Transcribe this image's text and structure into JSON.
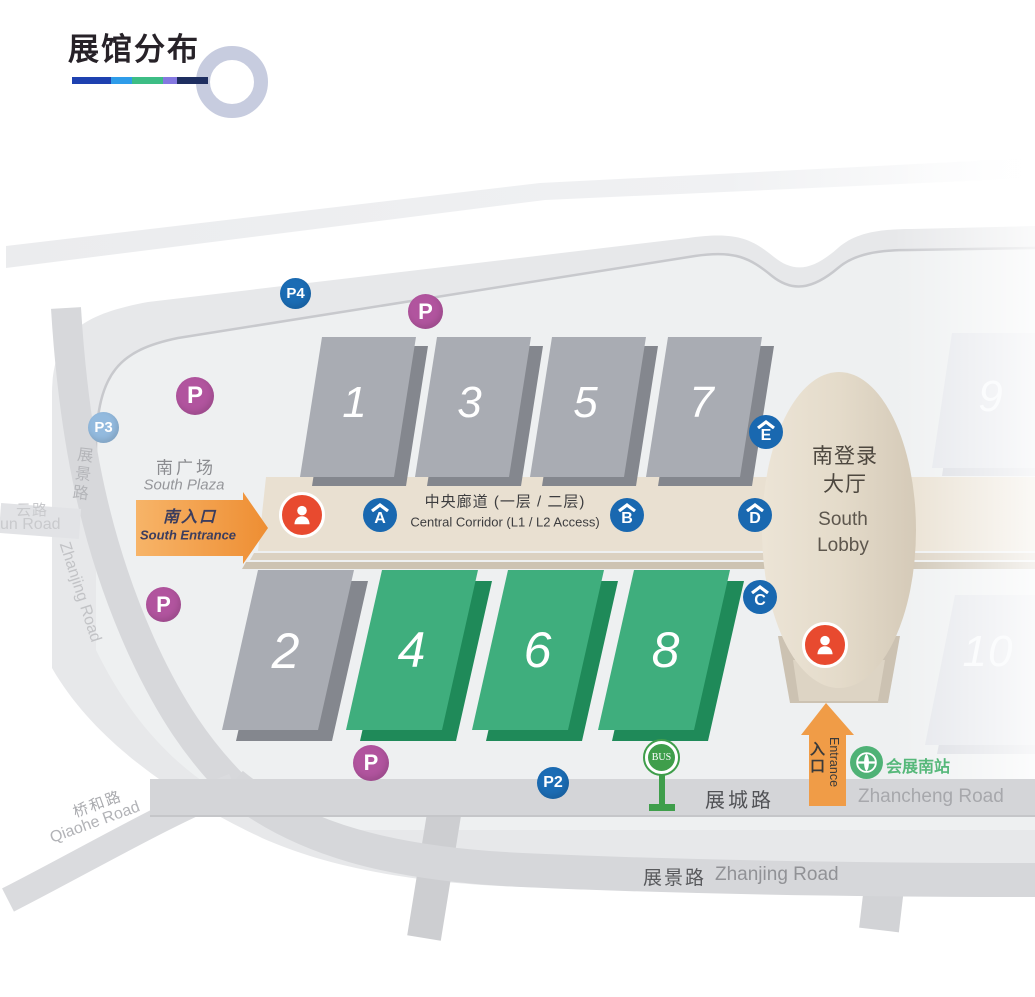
{
  "title": "展馆分布",
  "decor": {
    "underline_segments": [
      "#1e41b0",
      "#2e9ce9",
      "#3dbd85",
      "#8478e0",
      "#1e2e60"
    ],
    "ring_color": "#c7ccdf"
  },
  "colors": {
    "map_bg": "#e7e8ea",
    "map_inner": "#eef0f1",
    "road": "#d6d7da",
    "hall_gray_top": "#a9acb3",
    "hall_gray_side": "#84878e",
    "hall_green_top": "#3fae7d",
    "hall_green_side": "#1f8a59",
    "hall_faded_top": "#e4e6eb",
    "hall_faded_side": "#d9dbe1",
    "corridor": "#e9e0d1",
    "lobby": "#e2d9c8",
    "parking_purple": "#b1549e",
    "parking_blue": "#1b6cb4",
    "parking_lightblue": "#93bade",
    "gate_blue": "#1968b0",
    "person_red": "#e84a2f",
    "arrow_orange": "#f09c47",
    "bus_green": "#3f9e4b",
    "metro_green": "#4fb276"
  },
  "halls": [
    {
      "label": "1",
      "type": "gray"
    },
    {
      "label": "3",
      "type": "gray"
    },
    {
      "label": "5",
      "type": "gray"
    },
    {
      "label": "7",
      "type": "gray"
    },
    {
      "label": "9",
      "type": "faded"
    },
    {
      "label": "2",
      "type": "gray"
    },
    {
      "label": "4",
      "type": "green"
    },
    {
      "label": "6",
      "type": "green"
    },
    {
      "label": "8",
      "type": "green"
    },
    {
      "label": "10",
      "type": "faded"
    }
  ],
  "corridor": {
    "zh": "中央廊道 (一层 / 二层)",
    "en": "Central Corridor (L1 / L2 Access)"
  },
  "lobby": {
    "zh": "南登录大厅",
    "en": "South Lobby"
  },
  "plaza": {
    "zh": "南广场",
    "en": "South Plaza"
  },
  "south_entrance": {
    "zh": "南入口",
    "en": "South Entrance"
  },
  "entrance": {
    "zh": "入口",
    "en": "Entrance"
  },
  "gates": [
    {
      "letter": "A"
    },
    {
      "letter": "B"
    },
    {
      "letter": "C"
    },
    {
      "letter": "D"
    },
    {
      "letter": "E"
    }
  ],
  "parking": [
    {
      "label": "P4",
      "color": "#1b6cb4"
    },
    {
      "label": "P",
      "color": "#b1549e"
    },
    {
      "label": "P",
      "color": "#b1549e"
    },
    {
      "label": "P3",
      "color": "#93bade"
    },
    {
      "label": "P",
      "color": "#b1549e"
    },
    {
      "label": "P",
      "color": "#b1549e"
    },
    {
      "label": "P2",
      "color": "#1b6cb4"
    }
  ],
  "bus": {
    "label": "BUS"
  },
  "metro": {
    "label": "会展南站"
  },
  "roads": {
    "zhanjing_left": {
      "zh": "展景路",
      "en": "Zhanjing Road"
    },
    "zhanjing_bottom": {
      "zh": "展景路",
      "en": "Zhanjing Road"
    },
    "zhancheng": {
      "zh": "展城路",
      "en": "Zhancheng Road"
    },
    "qiaohe": {
      "zh": "桥和路",
      "en": "Qiaohe Road"
    },
    "yun": {
      "zh": "云路",
      "en": "un Road"
    }
  }
}
